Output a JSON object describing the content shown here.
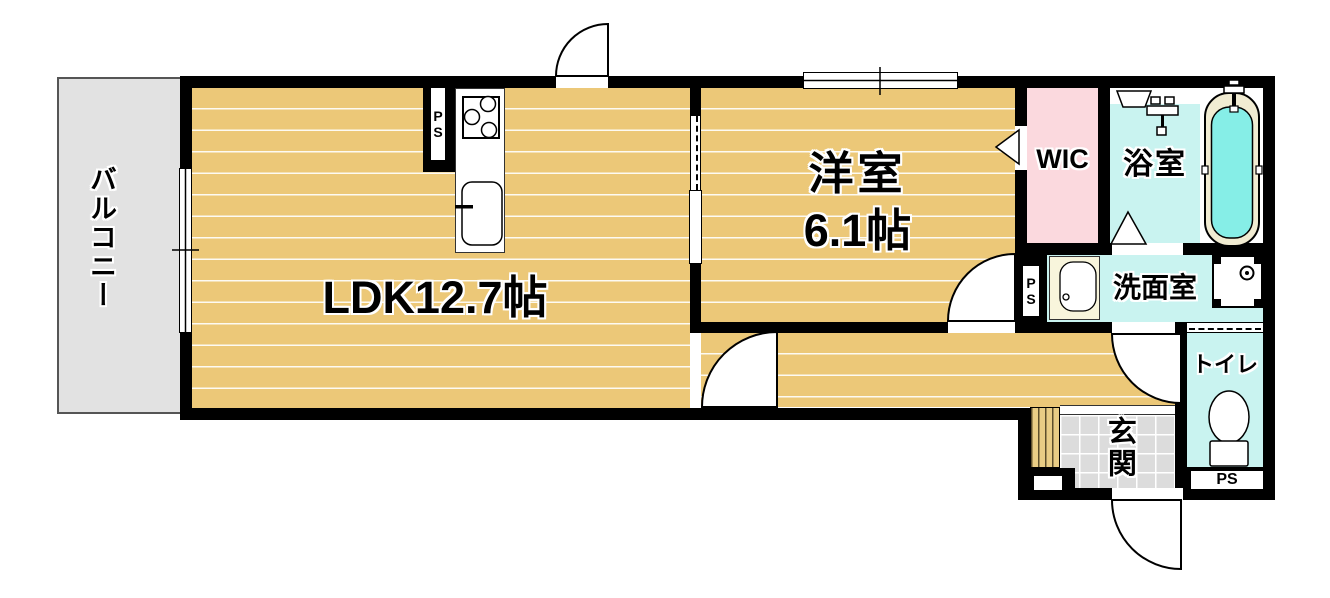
{
  "rooms": {
    "balcony": {
      "label": "バルコニー"
    },
    "ldk": {
      "label": "LDK12.7帖"
    },
    "western": {
      "name": "洋室",
      "size": "6.1帖"
    },
    "wic": {
      "label": "WIC"
    },
    "bathroom": {
      "label": "浴室"
    },
    "washroom": {
      "label": "洗面室"
    },
    "toilet": {
      "label": "トイレ"
    },
    "entrance": {
      "label": "玄関"
    }
  },
  "labels": {
    "pipe_space": "PS"
  },
  "colors": {
    "wall": "#000000",
    "wood_floor": "#ecc878",
    "balcony_gray": "#e2e2e2",
    "wic_pink": "#fbd9de",
    "wet_area_cyan": "#c9f3f0",
    "bathtub_water": "#86eee7",
    "tub_rim_cream": "#f1ecd2",
    "entrance_tile_gray": "#dcdcdc",
    "vanity_cream": "#f8f5dc"
  },
  "fixture_icons": [
    "gas-stove-icon",
    "kitchen-sink-icon",
    "bathtub-icon",
    "shower-mixer-icon",
    "bath-shelf-icon",
    "vanity-sink-icon",
    "washer-pan-icon",
    "toilet-bowl-icon",
    "door-swing-icon",
    "sliding-door-icon",
    "window-icon"
  ]
}
